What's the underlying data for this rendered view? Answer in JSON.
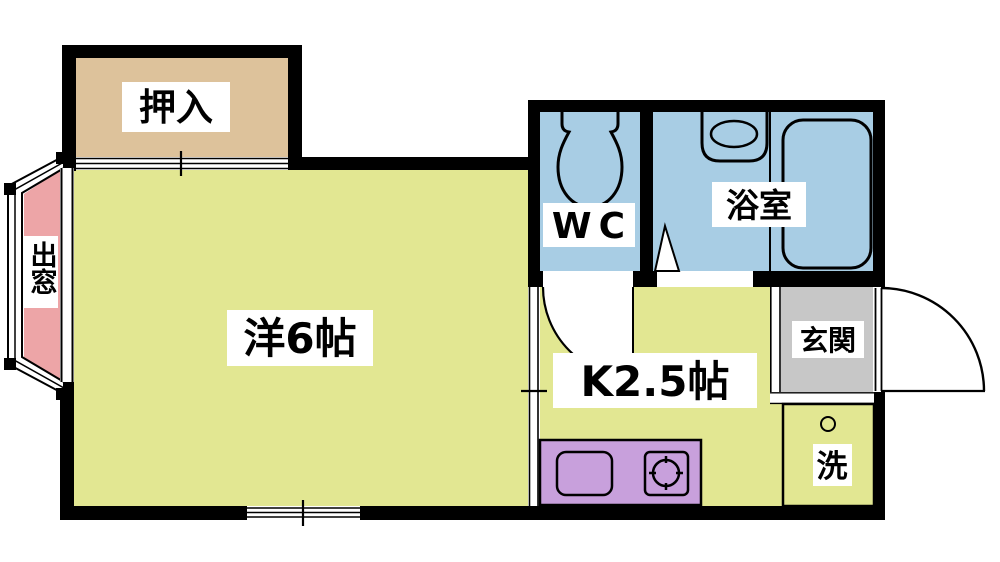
{
  "plan": {
    "type": "apartment-floor-plan",
    "rooms": {
      "closet": {
        "label": "押入"
      },
      "bay_window": {
        "label": "出窓"
      },
      "main_room": {
        "label": "洋6帖"
      },
      "wc": {
        "label": "WC"
      },
      "bath": {
        "label": "浴室"
      },
      "kitchen": {
        "label": "K2.5帖"
      },
      "entrance": {
        "label": "玄関"
      },
      "laundry": {
        "label": "洗"
      }
    },
    "icons": {
      "toilet-icon": "toilet tank and bowl outline in WC",
      "washbasin-icon": "wash basin with oval bowl in bath",
      "bathtub-icon": "rounded rectangle bathtub",
      "kitchen-sink-icon": "rounded rectangle sink on counter",
      "stove-burner-icon": "gas burner circle with four ticks",
      "washing-machine-icon": "box with small circle hose port",
      "door-swing-icon": "quarter-circle door swing arcs",
      "sliding-door-icon": "double-line sliding door symbols",
      "window-icon": "double-line window symbols"
    }
  },
  "colors": {
    "background": "#ffffff",
    "wall": "#000000",
    "room_yellow": "#e2e792",
    "closet_tan": "#ddc29b",
    "bay_pink": "#eda5a7",
    "wet_blue": "#a8cde4",
    "entry_gray": "#c7c7c7",
    "counter_purple": "#c8a0dc",
    "label_bg": "#ffffff",
    "line": "#000000"
  }
}
